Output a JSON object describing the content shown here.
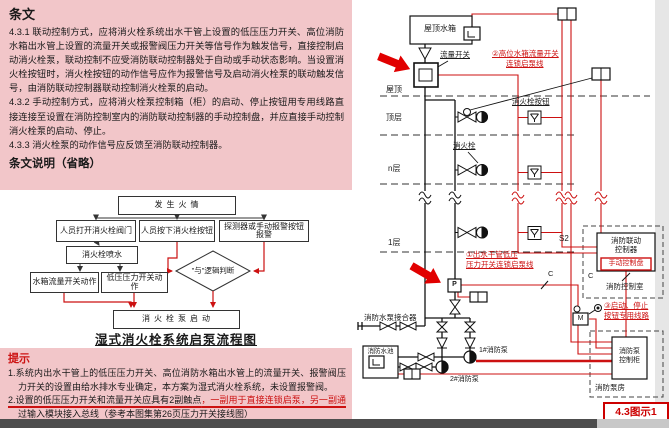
{
  "colors": {
    "pink_bg": "#f2c6c9",
    "red_accent": "#cc1111",
    "arrow_red": "#e10000",
    "dark_text": "#1a1a1a",
    "bottom_bar": "#4d4d4d"
  },
  "provisions": {
    "header": "条文",
    "clause_431": "4.3.1 联动控制方式，应将消火栓系统出水干管上设置的低压压力开关、高位消防水箱出水管上设置的流量开关或报警阀压力开关等信号作为触发信号，直接控制启动消火栓泵，联动控制不应受消防联动控制器处于自动或手动状态影响。当设置消火栓按钮时，消火栓按钮的动作信号应作为报警信号及启动消火栓泵的联动触发信号，由消防联动控制器联动控制消火栓泵的启动。",
    "clause_432": "4.3.2 手动控制方式，应将消火栓泵控制箱（柜）的启动、停止按钮用专用线路直接连接至设置在消防控制室内的消防联动控制器的手动控制盘，并应直接手动控制消火栓泵的启动、停止。",
    "clause_433": "4.3.3 消火栓泵的动作信号应反馈至消防联动控制器。",
    "explanation": "条文说明（省略）"
  },
  "flowchart": {
    "fire": "发生火情",
    "open_valve": "人员打开消火栓阀门",
    "press_button": "人员按下消火栓按钮",
    "detector": "探测器或手动报警按钮报警",
    "spray": "消火栓喷水",
    "flow_switch_act": "水箱流量开关动作",
    "pressure_switch_act": "低压压力开关动作",
    "and_logic": "\"与\"逻辑判断",
    "pump_start": "消火栓泵启动",
    "caption": "湿式消火栓系统启泵流程图"
  },
  "tips": {
    "header": "提示",
    "item1": "1.系统内出水干管上的低压压力开关、高位消防水箱出水管上的流量开关、报警阀压力开关的设置由给水排水专业确定，本方案为湿式消火栓系统，未设置报警阀。",
    "item2_black": "2.设置的低压压力开关和流量开关应具有2副触点",
    "item2_red": "，一副用于直接连锁启泵，另一副通",
    "item2_cont": "过输入模块接入总线（参考本图集第26页压力开关接线图）"
  },
  "diagram": {
    "roof_tank": "屋顶水箱",
    "flow_switch": "流量开关",
    "note_flow_1": "②高位水箱流量开关",
    "note_flow_2": "连锁启泵线",
    "floor_roof": "屋顶",
    "floor_top": "顶层",
    "floor_n": "n层",
    "floor_1": "1层",
    "hydrant_button": "消火栓按钮",
    "hydrant": "消火栓",
    "s2": "S2",
    "c1": "C",
    "c2": "C",
    "note_pressure_1": "①出水干管低压",
    "note_pressure_2": "压力开关连锁启泵线",
    "p": "P",
    "m": "M",
    "note_ss_1": "③启动、停止",
    "note_ss_2": "按钮专用线路",
    "controller_1": "消防联动",
    "controller_2": "控制器",
    "manual_panel": "手动控制盘",
    "control_room": "消防控制室",
    "siamese": "消防水泵接合器",
    "pool": "消防水池",
    "pump1": "1#消防泵",
    "pump2": "2#消防泵",
    "cabinet_1": "消防泵",
    "cabinet_2": "控制柜",
    "pump_room": "消防泵房",
    "figure": "4.3图示1"
  }
}
